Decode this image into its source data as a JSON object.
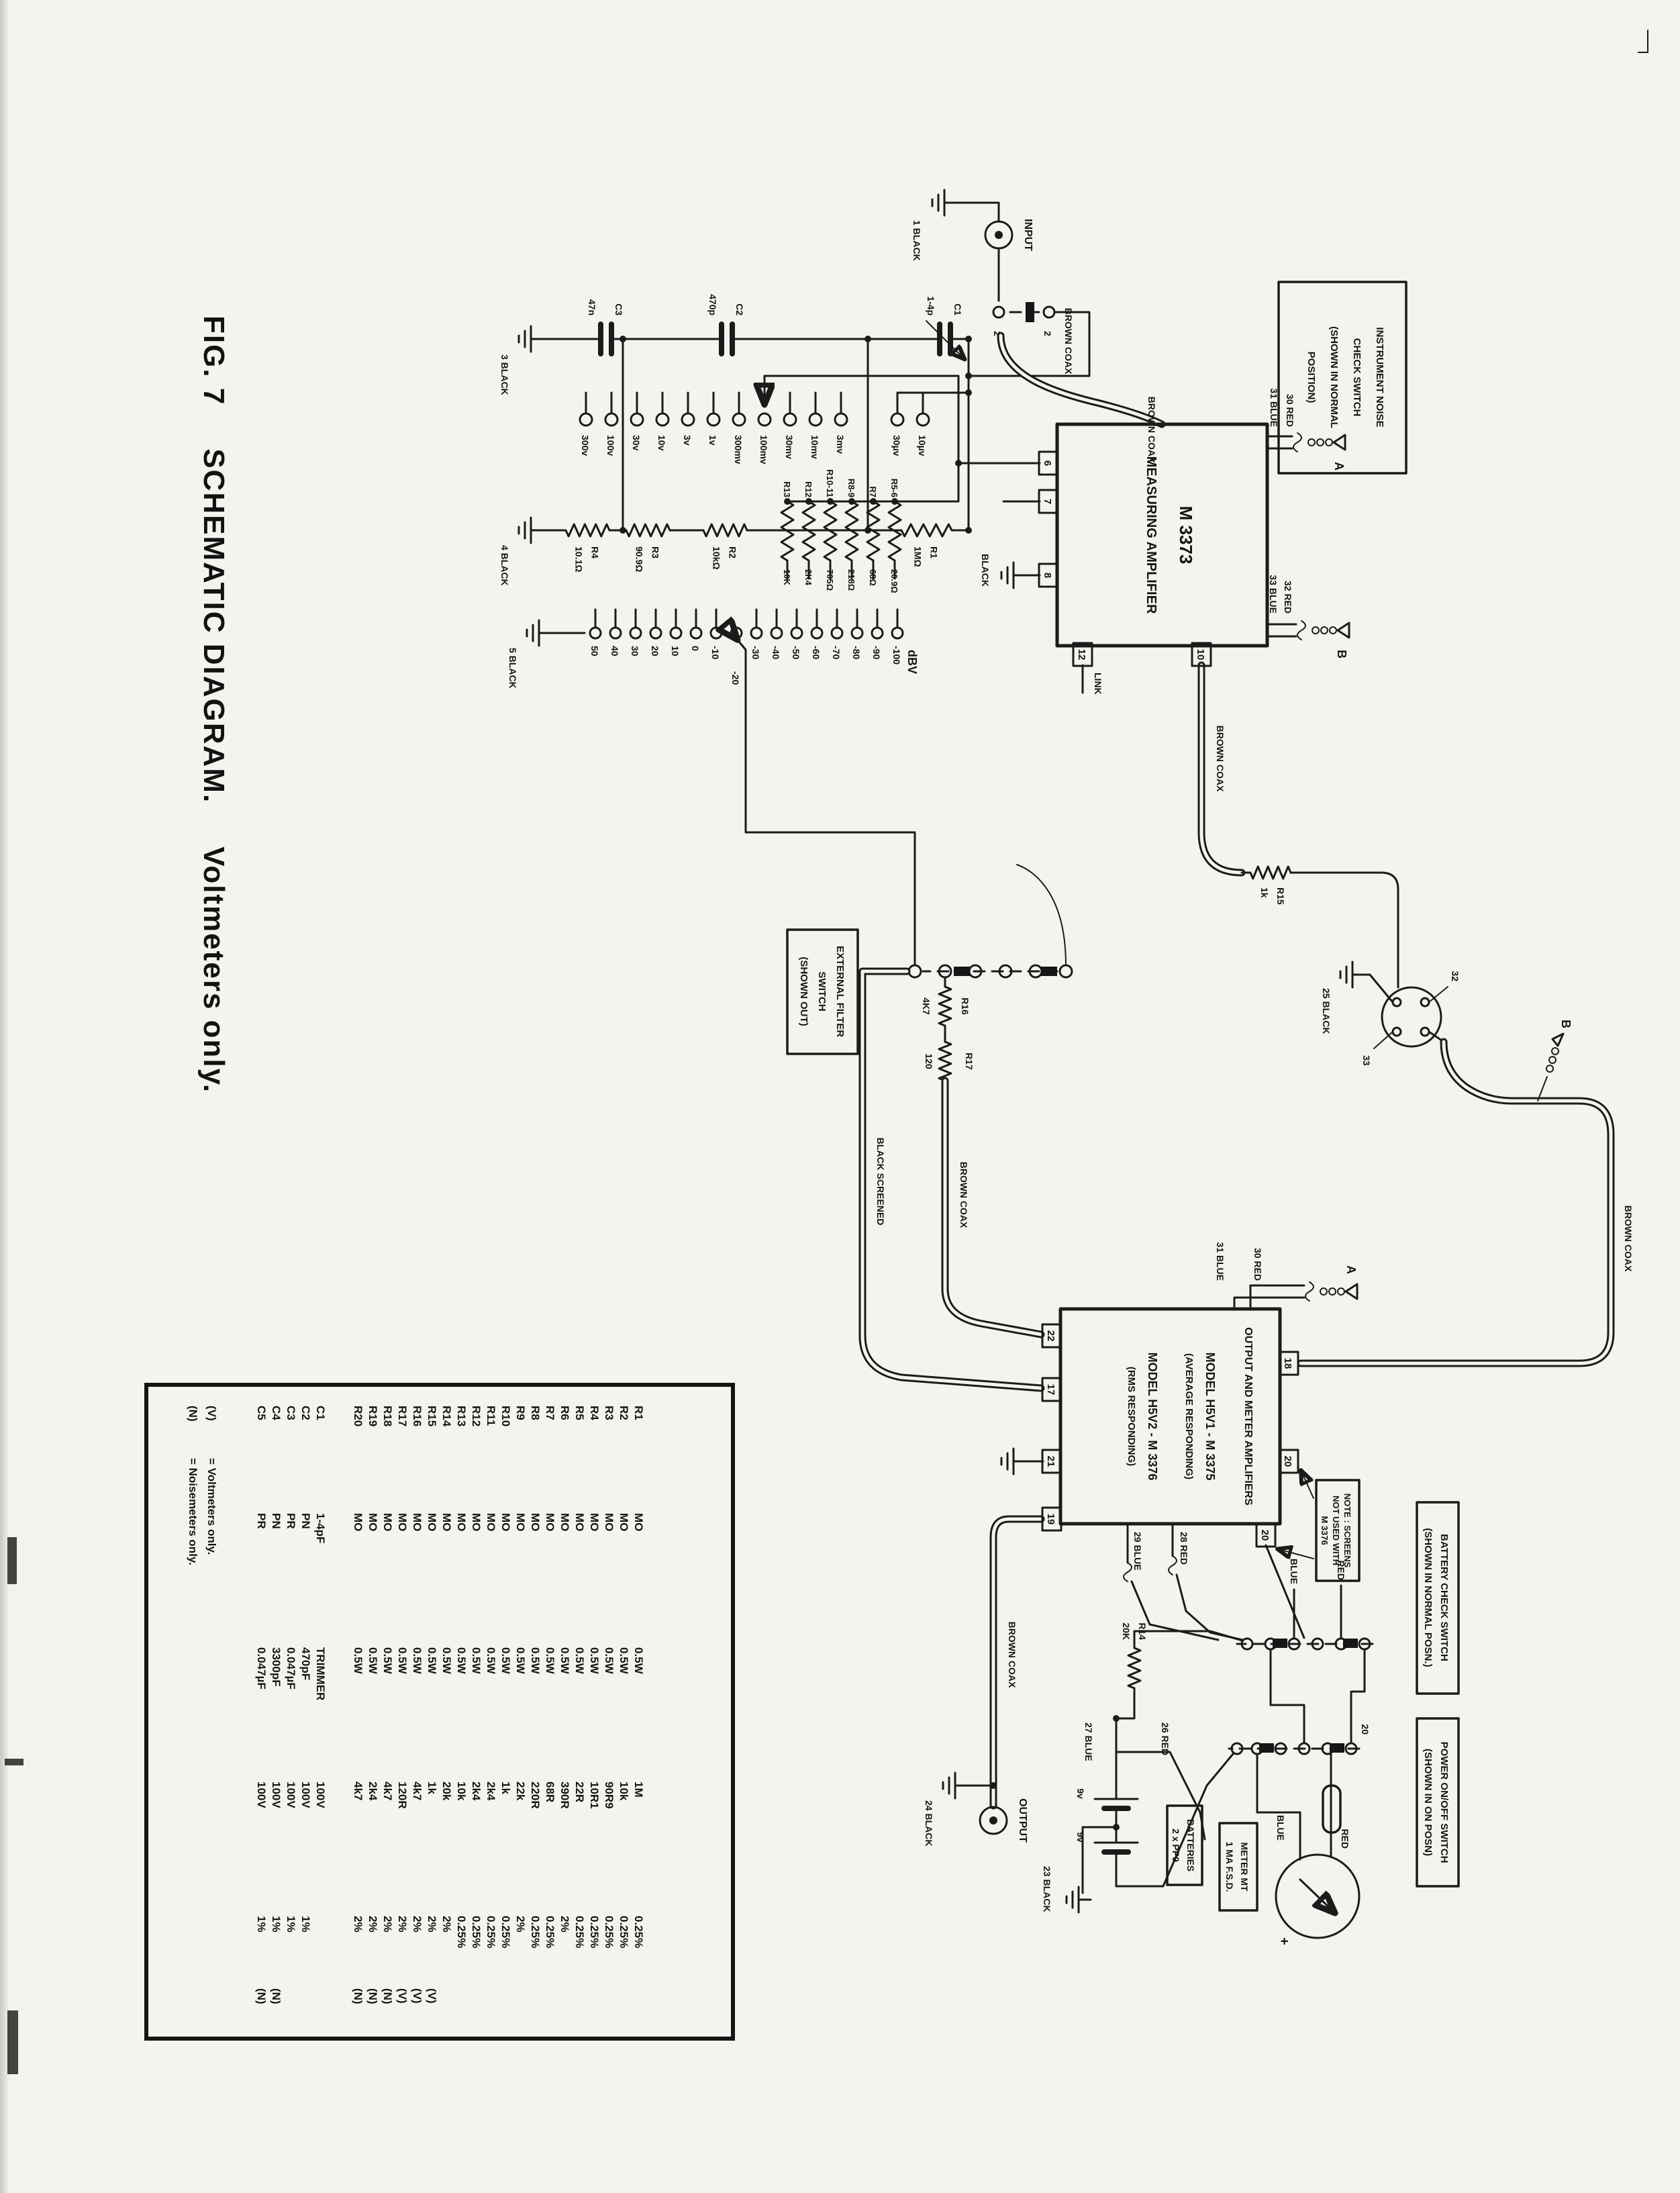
{
  "page": {
    "title_fig": "FIG. 7",
    "title_main": "SCHEMATIC DIAGRAM.",
    "title_sub": "Voltmeters only."
  },
  "schematic": {
    "input_label": "INPUT",
    "output_label": "OUTPUT",
    "link_label": "LINK",
    "dbv_label": "dBV",
    "switch_contact": "2",
    "meter_plus": "+",
    "battery_v": "9v",
    "grounds": {
      "g1": "1 BLACK",
      "g3": "3 BLACK",
      "g4": "4 BLACK",
      "g5": "5 BLACK",
      "g23": "23 BLACK",
      "g24": "24 BLACK",
      "g25": "25 BLACK",
      "amp": "BLACK"
    },
    "wire_labels": {
      "brown_coax": "BROWN COAX",
      "black_screened": "BLACK SCREENED",
      "blue": "BLUE",
      "red": "RED",
      "w30": "30 RED",
      "w31": "31 BLUE",
      "w32": "32 RED",
      "w33": "33 BLUE",
      "w26": "26 RED",
      "w27": "27 BLUE",
      "w28": "28 RED",
      "w29": "29 BLUE"
    },
    "clips": {
      "a": "A",
      "b": "B"
    },
    "noise_box": [
      "INSTRUMENT NOISE",
      "CHECK SWITCH",
      "(SHOWN IN NORMAL",
      "POSITION)"
    ],
    "ext_filter_box": [
      "EXTERNAL FILTER",
      "SWITCH",
      "(SHOWN OUT)"
    ],
    "note_box": [
      "NOTE : SCREENS",
      "NOT USED WITH",
      "M 3376"
    ],
    "battery_check_box": [
      "BATTERY CHECK SWITCH",
      "(SHOWN IN NORMAL POSN.)"
    ],
    "power_box": [
      "POWER ON/OFF SWITCH",
      "(SHOWN IN ON POSN)"
    ],
    "batteries_box": [
      "BATTERIES",
      "2 x PP9"
    ],
    "meter_box": [
      "METER MT",
      "1 MA F.S.D."
    ],
    "meas_amp": {
      "model": "M 3373",
      "name": "MEASURING AMPLIFIER"
    },
    "out_amp": [
      "OUTPUT AND METER AMPLIFIERS",
      "MODEL H5V1 - M 3375",
      "(AVERAGE RESPONDING)",
      "MODEL H5V2 - M 3376",
      "(RMS RESPONDING)"
    ],
    "att_caps": [
      {
        "name": "C1",
        "value": "1-4p"
      },
      {
        "name": "C2",
        "value": "470p"
      },
      {
        "name": "C3",
        "value": "47n"
      }
    ],
    "att_resistors": [
      {
        "name": "R1",
        "value": "1MΩ"
      },
      {
        "name": "R2",
        "value": "10kΩ"
      },
      {
        "name": "R3",
        "value": "90.9Ω"
      },
      {
        "name": "R4",
        "value": "10.1Ω"
      }
    ],
    "range_taps": [
      "10µv",
      "30µv",
      "3mv",
      "10mv",
      "30mv",
      "100mv",
      "300mv",
      "1v",
      "3v",
      "10v",
      "30v",
      "100v",
      "300v"
    ],
    "dbv_resistors": [
      {
        "name": "R5-6",
        "value": "20.9Ω"
      },
      {
        "name": "R7",
        "value": "68Ω"
      },
      {
        "name": "R8-9",
        "value": "218Ω"
      },
      {
        "name": "R10-11",
        "value": "705Ω"
      },
      {
        "name": "R12",
        "value": "2K4"
      },
      {
        "name": "R13",
        "value": "10K"
      }
    ],
    "dbv_taps": [
      "-100",
      "-90",
      "-80",
      "-70",
      "-60",
      "-50",
      "-40",
      "-30",
      "-20",
      "-10",
      "0",
      "10",
      "20",
      "30",
      "40",
      "50"
    ],
    "mid_resistors": {
      "r14": {
        "name": "R14",
        "value": "20K"
      },
      "r15": {
        "name": "R15",
        "value": "1k"
      },
      "r16": {
        "name": "R16",
        "value": "4K7"
      },
      "r17": {
        "name": "R17",
        "value": "120"
      }
    },
    "terminals": {
      "t2": "2",
      "t6": "6",
      "t7": "7",
      "t8": "8",
      "t10": "10",
      "t12": "12",
      "t17": "17",
      "t18": "18",
      "t19": "19",
      "t20": "20",
      "t21": "21",
      "t22": "22",
      "t32": "32",
      "t33": "33"
    }
  },
  "parts_table": {
    "rows": [
      {
        "ref": "R1",
        "c2": "MO",
        "c3": "0.5W",
        "c4": "1M",
        "c5": "0.25%",
        "c6": ""
      },
      {
        "ref": "R2",
        "c2": "MO",
        "c3": "0.5W",
        "c4": "10k",
        "c5": "0.25%",
        "c6": ""
      },
      {
        "ref": "R3",
        "c2": "MO",
        "c3": "0.5W",
        "c4": "90R9",
        "c5": "0.25%",
        "c6": ""
      },
      {
        "ref": "R4",
        "c2": "MO",
        "c3": "0.5W",
        "c4": "10R1",
        "c5": "0.25%",
        "c6": ""
      },
      {
        "ref": "R5",
        "c2": "MO",
        "c3": "0.5W",
        "c4": "22R",
        "c5": "0.25%",
        "c6": ""
      },
      {
        "ref": "R6",
        "c2": "MO",
        "c3": "0.5W",
        "c4": "390R",
        "c5": "2%",
        "c6": ""
      },
      {
        "ref": "R7",
        "c2": "MO",
        "c3": "0.5W",
        "c4": "68R",
        "c5": "0.25%",
        "c6": ""
      },
      {
        "ref": "R8",
        "c2": "MO",
        "c3": "0.5W",
        "c4": "220R",
        "c5": "0.25%",
        "c6": ""
      },
      {
        "ref": "R9",
        "c2": "MO",
        "c3": "0.5W",
        "c4": "22k",
        "c5": "2%",
        "c6": ""
      },
      {
        "ref": "R10",
        "c2": "MO",
        "c3": "0.5W",
        "c4": "1k",
        "c5": "0.25%",
        "c6": ""
      },
      {
        "ref": "R11",
        "c2": "MO",
        "c3": "0.5W",
        "c4": "2k4",
        "c5": "0.25%",
        "c6": ""
      },
      {
        "ref": "R12",
        "c2": "MO",
        "c3": "0.5W",
        "c4": "2k4",
        "c5": "0.25%",
        "c6": ""
      },
      {
        "ref": "R13",
        "c2": "MO",
        "c3": "0.5W",
        "c4": "10k",
        "c5": "0.25%",
        "c6": ""
      },
      {
        "ref": "R14",
        "c2": "MO",
        "c3": "0.5W",
        "c4": "20k",
        "c5": "2%",
        "c6": ""
      },
      {
        "ref": "R15",
        "c2": "MO",
        "c3": "0.5W",
        "c4": "1k",
        "c5": "2%",
        "c6": "(V)"
      },
      {
        "ref": "R16",
        "c2": "MO",
        "c3": "0.5W",
        "c4": "4k7",
        "c5": "2%",
        "c6": "(V)"
      },
      {
        "ref": "R17",
        "c2": "MO",
        "c3": "0.5W",
        "c4": "120R",
        "c5": "2%",
        "c6": "(V)"
      },
      {
        "ref": "R18",
        "c2": "MO",
        "c3": "0.5W",
        "c4": "4k7",
        "c5": "2%",
        "c6": "(N)"
      },
      {
        "ref": "R19",
        "c2": "MO",
        "c3": "0.5W",
        "c4": "2k4",
        "c5": "2%",
        "c6": "(N)"
      },
      {
        "ref": "R20",
        "c2": "MO",
        "c3": "0.5W",
        "c4": "4k7",
        "c5": "2%",
        "c6": "(N)"
      },
      {
        "ref": "C1",
        "c2": "1-4pF",
        "c3": "TRIMMER",
        "c4": "100V",
        "c5": "",
        "c6": ""
      },
      {
        "ref": "C2",
        "c2": "PN",
        "c3": "470pF",
        "c4": "100V",
        "c5": "1%",
        "c6": ""
      },
      {
        "ref": "C3",
        "c2": "PR",
        "c3": "0.047µF",
        "c4": "100V",
        "c5": "1%",
        "c6": ""
      },
      {
        "ref": "C4",
        "c2": "PN",
        "c3": "3300pF",
        "c4": "100V",
        "c5": "1%",
        "c6": "(N)"
      },
      {
        "ref": "C5",
        "c2": "PR",
        "c3": "0.047µF",
        "c4": "100V",
        "c5": "1%",
        "c6": "(N)"
      }
    ],
    "legend": [
      {
        "sym": "(V)",
        "text": "=   Voltmeters only."
      },
      {
        "sym": "(N)",
        "text": "=   Noisemeters only."
      }
    ]
  }
}
